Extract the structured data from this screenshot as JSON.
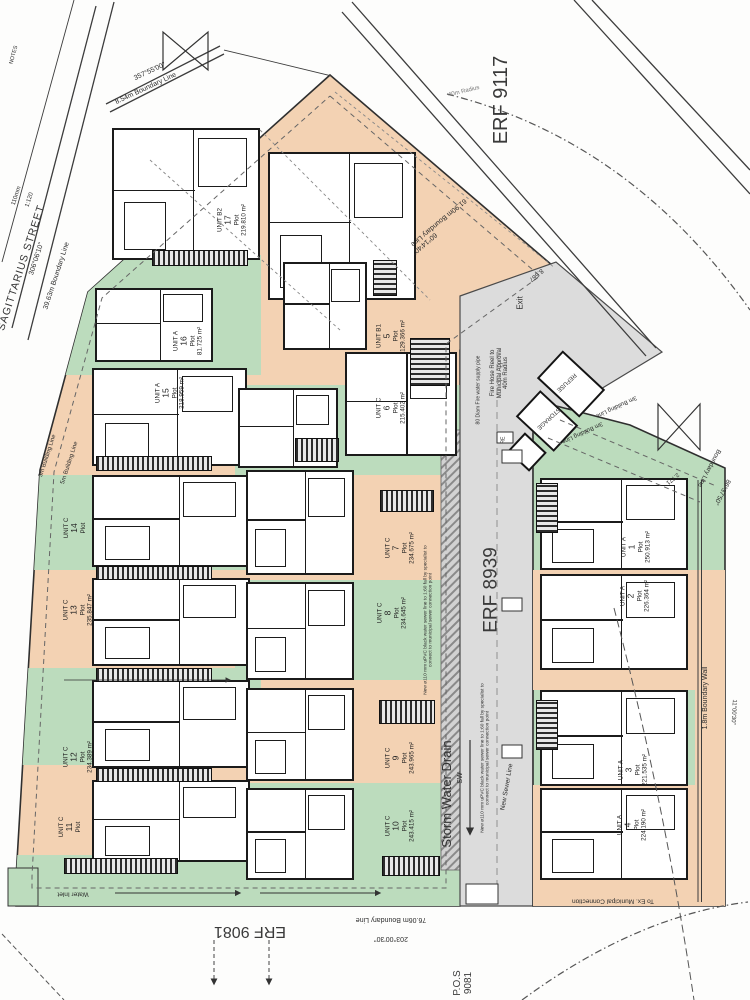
{
  "street": {
    "name": "SAGITTARIUS STREET",
    "bearing": "306°06'10\"",
    "boundary": "39.63m Boundary Line"
  },
  "erven": {
    "top": "ERF 9117",
    "main": "ERF 8939",
    "bottom": "ERF 9081",
    "pos": "P.O.S",
    "pos_number": "9081"
  },
  "boundaries": {
    "top_left_bearing": "357°55'00\"",
    "top_left": "8.54m Boundary Line",
    "top_right_bearing": "60°14'40\"",
    "top_right": "61.90m Boundary Line",
    "bottom_bearing": "203°00'30\"",
    "bottom": "76.06m Boundary Line",
    "right_bearing": "86°37'50\"",
    "right": "Boundary Line",
    "right_lower_bearing": "11°00'30\"",
    "boundary_wall": "1.8m Boundary Wall"
  },
  "annotations": {
    "notes": "NOTES",
    "paper": "110mm",
    "scale": "1:120",
    "building_line_3m": "3m Building Line",
    "building_line_5m": "5m Building Line",
    "radius_40m": "40m Radius",
    "exit": "Exit",
    "fire_line1": "Fire Hose Reel to",
    "fire_line2": "Municipal Approval",
    "fire_line3": "40m Radius",
    "fire_pipe": "80 Diam Fire water supply pipe",
    "refuse": "REFUSE",
    "storage": "STORAGE",
    "re": "RE",
    "dim_8567": "8.567",
    "dim_2771": "2.771",
    "storm_water_drain": "Storm Water Drain",
    "sw": "SW",
    "new_sewer_line": "New Sewer Line",
    "sewer_note": "New ø110 mm uPVC black water sewer line to 1:60 fall by specialist to connect to municipal sewer connection point",
    "water_inlet": "Water Inlet",
    "municipal_connection": "To Ex. Municipal Connection"
  },
  "labels": {
    "plot": "Plot"
  },
  "colors": {
    "peach": "#f3d2b3",
    "green": "#bcdcbd",
    "road_gray": "#dcdcdc",
    "line": "#2f2f2f"
  },
  "units": [
    {
      "name": "UNIT A",
      "number": "1",
      "area": "250.913 m²"
    },
    {
      "name": "UNIT A",
      "number": "2",
      "area": "226.364 m²"
    },
    {
      "name": "UNIT A",
      "number": "3",
      "area": "221.535 m²"
    },
    {
      "name": "UNIT A",
      "number": "4",
      "area": "224.190 m²"
    },
    {
      "name": "UNIT B1",
      "number": "5",
      "area": "129.366 m²"
    },
    {
      "name": "UNIT C",
      "number": "6",
      "area": "215.402 m²"
    },
    {
      "name": "UNIT C",
      "number": "7",
      "area": "234.675 m²"
    },
    {
      "name": "UNIT C",
      "number": "8",
      "area": "234.645 m²"
    },
    {
      "name": "UNIT C",
      "number": "9",
      "area": "243.965 m²"
    },
    {
      "name": "UNIT C",
      "number": "10",
      "area": "243.415 m²"
    },
    {
      "name": "UNIT C",
      "number": "11",
      "area": ""
    },
    {
      "name": "UNIT C",
      "number": "12",
      "area": "234.389 m²"
    },
    {
      "name": "UNIT C",
      "number": "13",
      "area": "235.847 m²"
    },
    {
      "name": "UNIT C",
      "number": "14",
      "area": ""
    },
    {
      "name": "UNIT A",
      "number": "15",
      "area": "218.959 m²"
    },
    {
      "name": "UNIT A",
      "number": "16",
      "area": "81.725 m²"
    },
    {
      "name": "UNIT B2",
      "number": "17",
      "area": "219.810 m²"
    }
  ]
}
